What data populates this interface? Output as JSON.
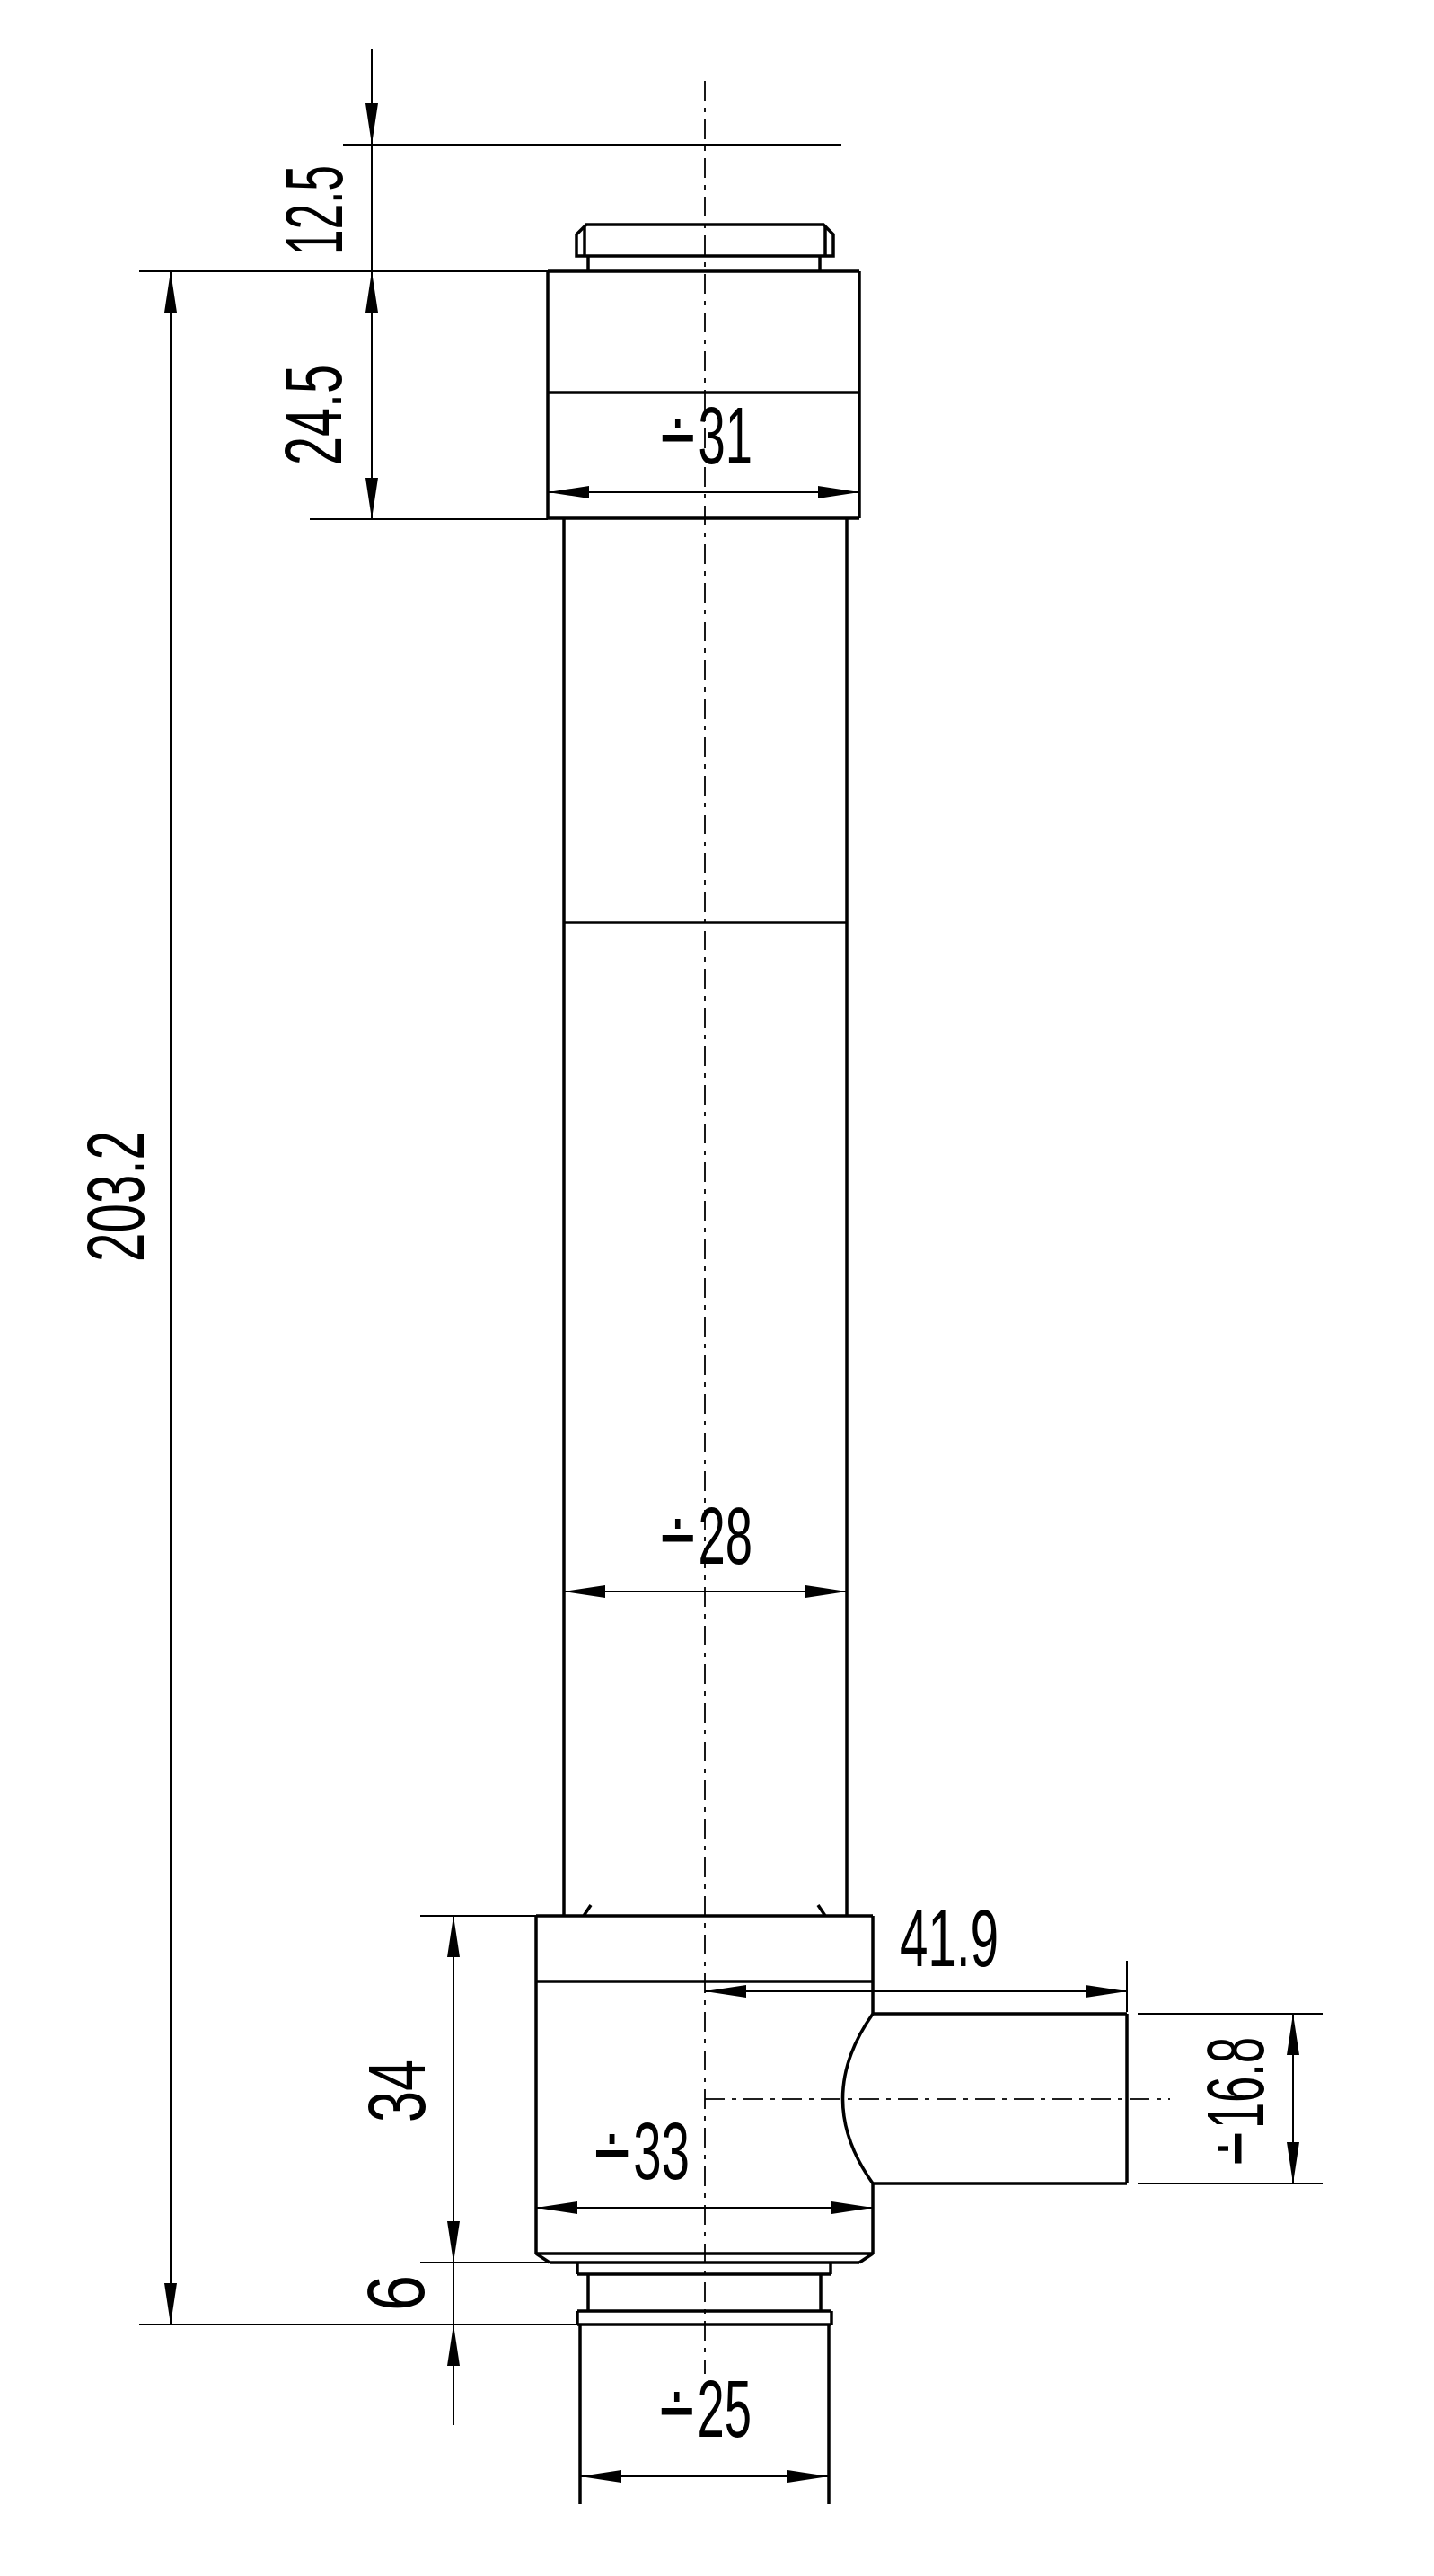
{
  "drawing": {
    "background_color": "#ffffff",
    "line_color": "#000000",
    "units": "mm"
  },
  "dims": {
    "offset_top": {
      "label": "12.5",
      "value": 12.5,
      "orientation": "vertical"
    },
    "head_height": {
      "label": "24.5",
      "value": 24.5,
      "orientation": "vertical"
    },
    "head_dia": {
      "label": "∸31",
      "value": 31,
      "orientation": "horizontal"
    },
    "overall_len": {
      "label": "203.2",
      "value": 203.2,
      "orientation": "vertical"
    },
    "tube_dia": {
      "label": "∸28",
      "value": 28,
      "orientation": "horizontal"
    },
    "port_len": {
      "label": "41.9",
      "value": 41.9,
      "orientation": "horizontal"
    },
    "port_dia": {
      "label": "∸16.8",
      "value": 16.8,
      "orientation": "vertical"
    },
    "block_height": {
      "label": "34",
      "value": 34,
      "orientation": "vertical"
    },
    "block_dia": {
      "label": "∸33",
      "value": 33,
      "orientation": "horizontal"
    },
    "flange_height": {
      "label": "6",
      "value": 6,
      "orientation": "vertical"
    },
    "spigot_dia": {
      "label": "∸25",
      "value": 25,
      "orientation": "horizontal"
    }
  }
}
